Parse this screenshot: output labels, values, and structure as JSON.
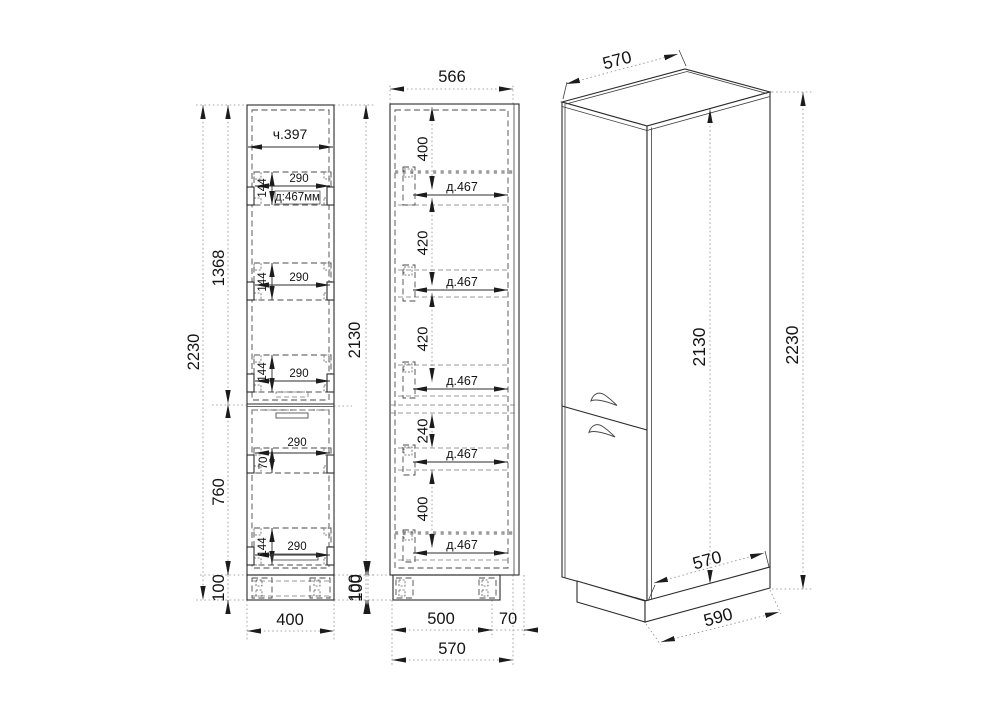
{
  "drawing_title": "Tall cabinet dimensional drawing",
  "colors": {
    "background": "#ffffff",
    "line": "#2b2b2b",
    "shelf_dotted": "#9c9c9c"
  },
  "front": {
    "width_label": "ч.397",
    "total_height": "2230",
    "upper_height": "1368",
    "lower_height": "760",
    "plinth_left": "100",
    "body_height": "2130",
    "plinth_right": "100",
    "bottom_width": "400",
    "drawers": [
      {
        "h": "144",
        "w": "290",
        "depth": "д:467мм"
      },
      {
        "h": "144",
        "w": "290"
      },
      {
        "h": "144",
        "w": "290"
      },
      {
        "h": "70",
        "w": "290"
      },
      {
        "h": "144",
        "w": "290"
      }
    ]
  },
  "side": {
    "top_width": "566",
    "gaps": [
      "400",
      "420",
      "420",
      "240",
      "400"
    ],
    "shelves": [
      "д.467",
      "д.467",
      "д.467",
      "д.467",
      "д.467"
    ],
    "plinth": "100",
    "base_depth": "500",
    "front_offset": "70",
    "total_depth": "570"
  },
  "iso": {
    "top_depth": "570",
    "body_height": "2130",
    "total_height": "2230",
    "bottom_depth": "570",
    "base_depth": "590"
  }
}
